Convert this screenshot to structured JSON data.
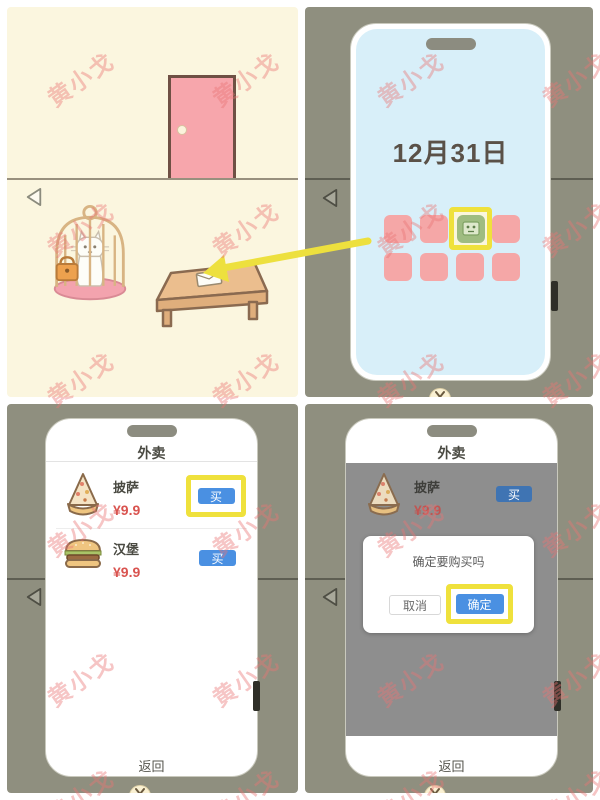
{
  "watermark": {
    "text": "黄小戈",
    "color": "#E97474"
  },
  "colors": {
    "highlight_yellow": "#EFE13C",
    "buy_blue": "#4A90E2",
    "price_red": "#D9534F",
    "app_pink": "#F5A7A7",
    "app_green": "#9FBC81",
    "screen_blue": "#D8EFF9",
    "room_cream": "#FBF6DF",
    "scene_gray": "#8F8F7F",
    "door_pink": "#F7A6AC",
    "dim_overlay": "#8E8E8E"
  },
  "panels": {
    "phone_home": {
      "date": "12月31日"
    },
    "shop": {
      "title": "外卖",
      "items": [
        {
          "name": "披萨",
          "price": "¥9.9",
          "buy_label": "买"
        },
        {
          "name": "汉堡",
          "price": "¥9.9",
          "buy_label": "买"
        }
      ],
      "back_label": "返回"
    },
    "confirm": {
      "title": "外卖",
      "item": {
        "name": "披萨",
        "price": "¥9.9",
        "buy_label": "买"
      },
      "dialog": {
        "message": "确定要购买吗",
        "cancel_label": "取消",
        "confirm_label": "确定"
      },
      "back_label": "返回"
    }
  }
}
